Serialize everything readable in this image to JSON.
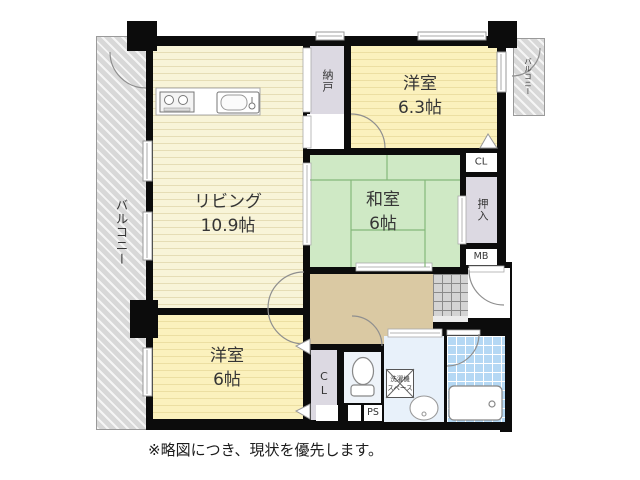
{
  "plan": {
    "rooms": {
      "living": {
        "name": "リビング",
        "size": "10.9帖"
      },
      "western_63": {
        "name": "洋室",
        "size": "6.3帖"
      },
      "japanese_6": {
        "name": "和室",
        "size": "6帖"
      },
      "western_6": {
        "name": "洋室",
        "size": "6帖"
      },
      "storage_nando": {
        "name": "納戸"
      },
      "oshiire": {
        "name": "押入"
      },
      "closet_upper": {
        "label": "CL"
      },
      "closet_lower": {
        "label": "CL"
      },
      "meter_box": {
        "label": "MB"
      },
      "pipe_shaft": {
        "label": "PS"
      },
      "balcony_left": {
        "name": "バルコニー"
      },
      "balcony_upper_right": {
        "name": "バルコニー"
      },
      "laundry_space": {
        "line1": "洗濯機",
        "line2": "スペース"
      }
    },
    "note": "※略図につき、現状を優先します。",
    "colors": {
      "wall": "#0c0c0c",
      "flooring": "#f8f4d8",
      "bedroom": "#fbf1bd",
      "tatami": "#cfe9c5",
      "hallway": "#dac9a3",
      "closet": "#dcd9e2",
      "bath_tile": "#b4d8f4",
      "balcony": "#d8d8d8"
    }
  }
}
